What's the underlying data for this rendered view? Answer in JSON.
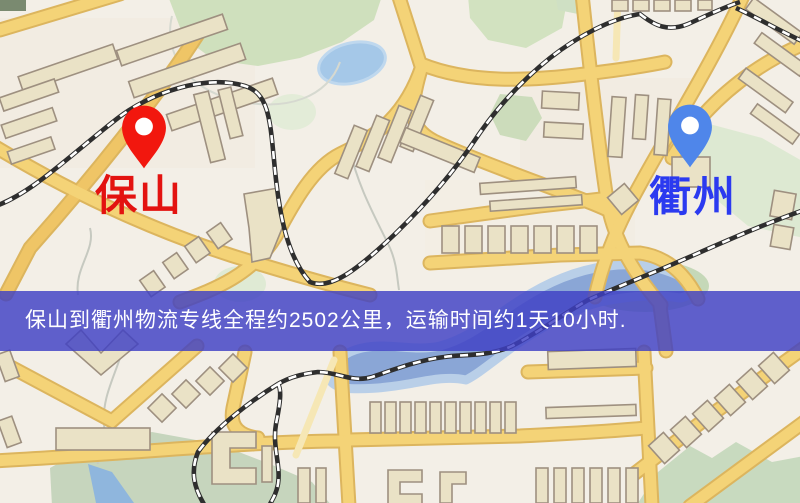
{
  "map": {
    "origin": {
      "name": "保山",
      "pin_color": "#f2170e",
      "label_color": "#e31310"
    },
    "destination": {
      "name": "衢州",
      "pin_color": "#4f86ea",
      "label_color": "#2b3af0"
    },
    "banner": {
      "text": "保山到衢州物流专线全程约2502公里，运输时间约1天10小时.",
      "background_color": "#3e40c4",
      "text_color": "#ffffff",
      "distance_km": "2502",
      "duration": "1天10小时"
    },
    "palette": {
      "map_background": "#f3efe7",
      "road_fill": "#f4d377",
      "road_casing": "#dcb55e",
      "building_fill": "#eae2c6",
      "building_stroke": "#9e9080",
      "park_green": "#cfe0bd",
      "water_blue": "#8aa6d6",
      "pond_blue": "#a5c8e8",
      "railway_dark": "#2e2e2e"
    }
  }
}
